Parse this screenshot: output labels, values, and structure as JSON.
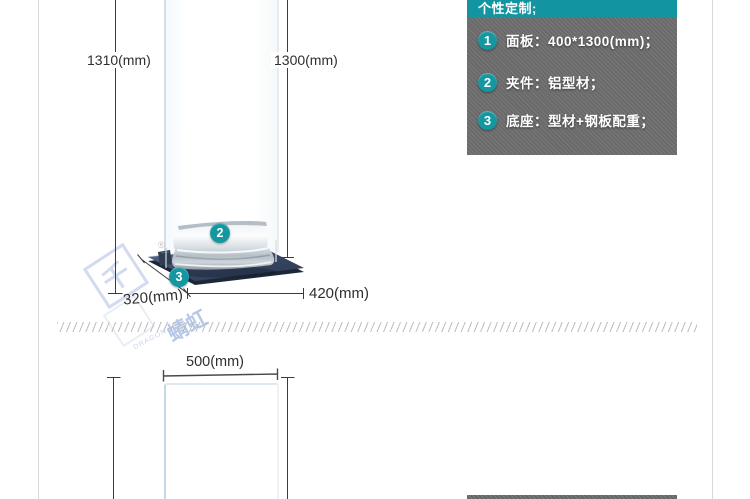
{
  "colors": {
    "accent_teal": "#1295a0",
    "spec_body_gray": "#6f6f6f",
    "base_navy": "#3d4e66",
    "dim_line": "#3b3b3b",
    "watermark_blue": "#aebfe2",
    "page_border": "#d9d9d9"
  },
  "spec_panel": {
    "header": "个性定制;",
    "items": [
      {
        "num": "1",
        "text": "面板：400*1300(mm)；"
      },
      {
        "num": "2",
        "text": "夹件：铝型材；"
      },
      {
        "num": "3",
        "text": "底座：型材+钢板配重；"
      }
    ]
  },
  "top_diagram": {
    "height_total": "1310(mm)",
    "height_panel": "1300(mm)",
    "base_depth": "320(mm)",
    "base_width": "420(mm)",
    "badge_clamp": "2",
    "badge_base": "3"
  },
  "bottom_diagram": {
    "panel_width": "500(mm)"
  },
  "watermark": {
    "glyph": "千",
    "cn": "蜻虹",
    "en": "DRAGON",
    "reg": "®"
  }
}
